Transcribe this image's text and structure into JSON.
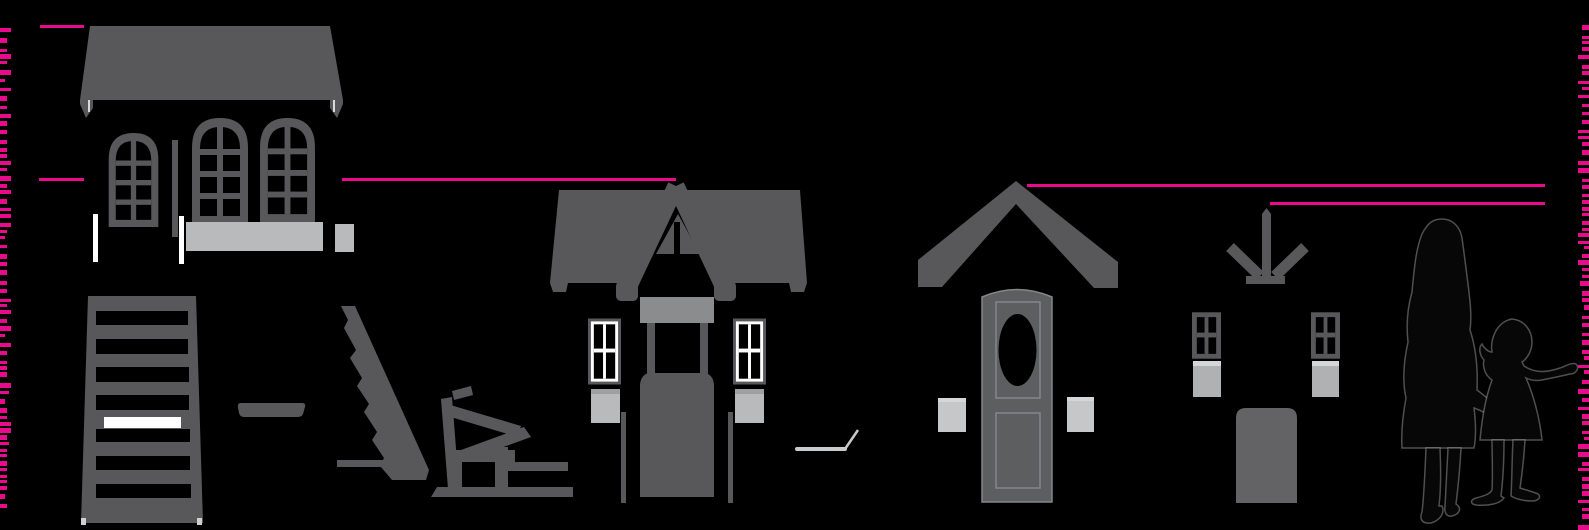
{
  "meta": {
    "description": "Silhouette size-comparison diagram: large playhouse, slat ladder, shelf, ramp, bench, medium gabled playhouse, porch-roof door unit, arrow assembly kit with windows and door, adult and child silhouettes, with magenta height measurement lines and dashed edge rulers",
    "canvas": {
      "width": 1589,
      "height": 530
    }
  },
  "colors": {
    "background": "#000000",
    "structure": "#58585a",
    "structure_mid": "#8b8c8e",
    "structure_light": "#b9babc",
    "box_light": "#c6c7c9",
    "box_top": "#d5d6d8",
    "box_shade": "#9fa0a2",
    "door_porch": "#5d5e60",
    "door_outline": "#85868a",
    "stick": "#c9cacc",
    "accent": "#EA0B8C",
    "white": "#ffffff",
    "silhouette": "#070707",
    "silhouette_outline": "rgba(255,255,255,0.3)"
  },
  "measurement_lines": [
    {
      "name": "height-line-playhouse-large",
      "y": 26,
      "segments": [
        [
          40,
          84
        ]
      ]
    },
    {
      "name": "height-line-playhouse-medium",
      "y": 179,
      "segments": [
        [
          39,
          84
        ],
        [
          342,
          676
        ]
      ]
    },
    {
      "name": "height-line-porch-door",
      "y": 185,
      "segments": [
        [
          1027,
          1545
        ]
      ]
    },
    {
      "name": "height-line-arrow-kit",
      "y": 203,
      "segments": [
        [
          1270,
          1545
        ]
      ]
    }
  ],
  "rulers": {
    "left": {
      "align": "left",
      "top": 28,
      "bottom": 506,
      "base_width": 7,
      "seed": 7
    },
    "right": {
      "align": "right",
      "top": 25,
      "bottom": 528,
      "base_width": 7,
      "seed": 13
    }
  },
  "figures": [
    "playhouse-large",
    "slat-ladder",
    "shelf-board",
    "stepped-ramp",
    "garden-bench",
    "playhouse-medium",
    "garden-stick",
    "porch-door-unit",
    "arrow-kit",
    "adult-silhouette",
    "child-silhouette"
  ]
}
